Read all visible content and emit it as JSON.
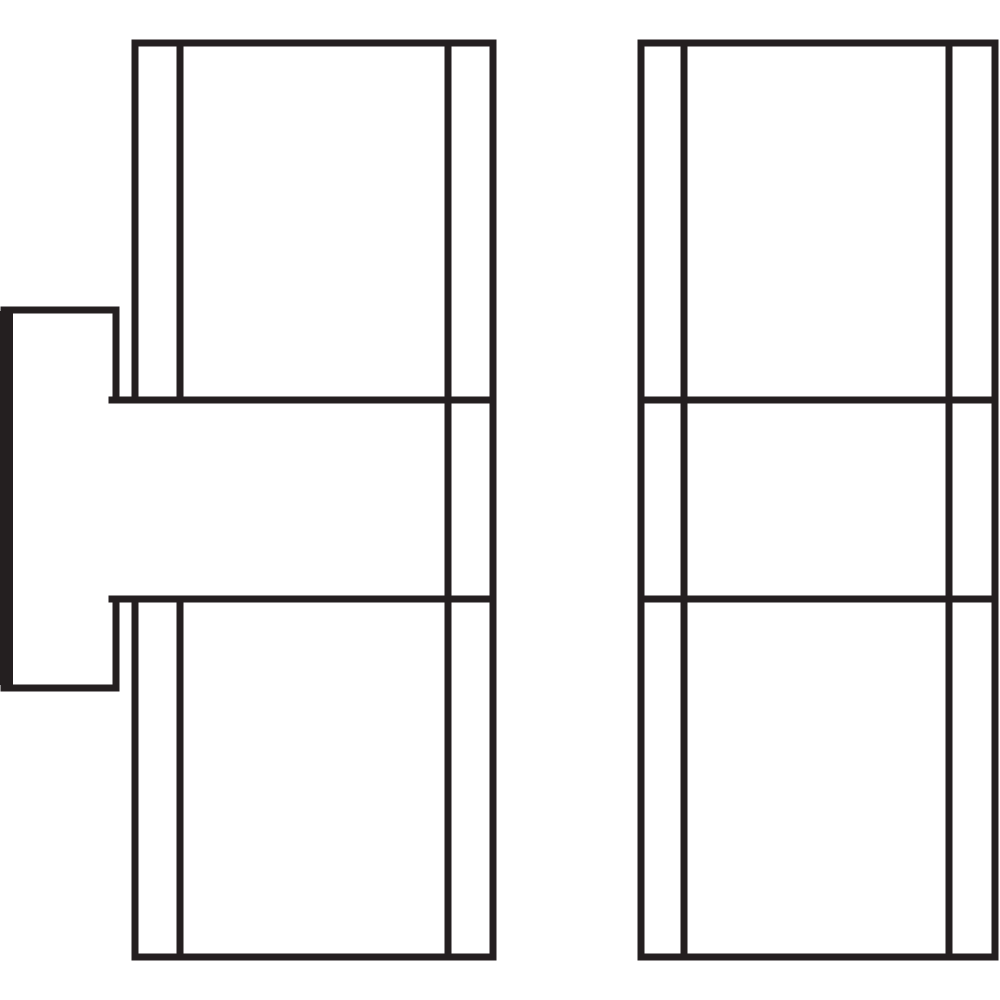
{
  "figure": {
    "width": 1000,
    "height": 1000,
    "background_color": "#ffffff",
    "stroke_color": "#241f20",
    "stroke_width": 7,
    "description": "line-art cross-section diagram: two vertical rails with inner wall lines and two horizontal divider lines, plus a T-shaped tab with thick black left edge on the far left",
    "thick_bar": {
      "name": "tab-thick-left-edge",
      "x": 0,
      "y": 311,
      "width": 13,
      "height": 374
    },
    "segments": [
      {
        "name": "left-rail-top-edge",
        "x1": 135,
        "y1": 43,
        "x2": 493,
        "y2": 43
      },
      {
        "name": "left-rail-bottom-edge",
        "x1": 135,
        "y1": 957,
        "x2": 493,
        "y2": 957
      },
      {
        "name": "left-rail-outer-left-wall-upper",
        "x1": 135,
        "y1": 43,
        "x2": 135,
        "y2": 400
      },
      {
        "name": "left-rail-outer-left-wall-lower",
        "x1": 135,
        "y1": 599,
        "x2": 135,
        "y2": 957
      },
      {
        "name": "left-rail-inner-left-wall-upper",
        "x1": 180,
        "y1": 43,
        "x2": 180,
        "y2": 400
      },
      {
        "name": "left-rail-inner-left-wall-lower",
        "x1": 180,
        "y1": 599,
        "x2": 180,
        "y2": 957
      },
      {
        "name": "left-rail-inner-right-wall",
        "x1": 448,
        "y1": 43,
        "x2": 448,
        "y2": 957
      },
      {
        "name": "left-rail-outer-right-wall",
        "x1": 493,
        "y1": 43,
        "x2": 493,
        "y2": 957
      },
      {
        "name": "left-rail-upper-divider",
        "x1": 112,
        "y1": 400,
        "x2": 493,
        "y2": 400
      },
      {
        "name": "left-rail-lower-divider",
        "x1": 112,
        "y1": 599,
        "x2": 493,
        "y2": 599
      },
      {
        "name": "tab-top-edge",
        "x1": 4,
        "y1": 310,
        "x2": 116,
        "y2": 310
      },
      {
        "name": "tab-bottom-edge",
        "x1": 4,
        "y1": 688,
        "x2": 116,
        "y2": 688
      },
      {
        "name": "tab-right-edge-upper",
        "x1": 116,
        "y1": 310,
        "x2": 116,
        "y2": 400
      },
      {
        "name": "tab-right-edge-lower",
        "x1": 116,
        "y1": 599,
        "x2": 116,
        "y2": 688
      },
      {
        "name": "right-rail-top-edge",
        "x1": 641,
        "y1": 43,
        "x2": 995,
        "y2": 43
      },
      {
        "name": "right-rail-bottom-edge",
        "x1": 641,
        "y1": 957,
        "x2": 995,
        "y2": 957
      },
      {
        "name": "right-rail-outer-left-wall",
        "x1": 641,
        "y1": 43,
        "x2": 641,
        "y2": 957
      },
      {
        "name": "right-rail-inner-left-wall",
        "x1": 684,
        "y1": 43,
        "x2": 684,
        "y2": 957
      },
      {
        "name": "right-rail-inner-right-wall",
        "x1": 949,
        "y1": 43,
        "x2": 949,
        "y2": 957
      },
      {
        "name": "right-rail-outer-right-wall",
        "x1": 995,
        "y1": 43,
        "x2": 995,
        "y2": 957
      },
      {
        "name": "right-rail-upper-divider",
        "x1": 641,
        "y1": 400,
        "x2": 995,
        "y2": 400
      },
      {
        "name": "right-rail-lower-divider",
        "x1": 641,
        "y1": 599,
        "x2": 995,
        "y2": 599
      }
    ]
  }
}
